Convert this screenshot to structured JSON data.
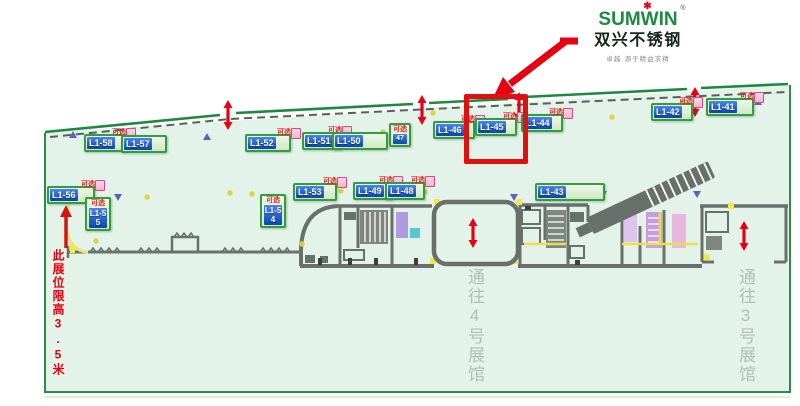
{
  "brand": {
    "logo_text": "SUMWIN",
    "logo_reg": "®",
    "logo_star": "✱",
    "name_cn": "双兴不锈钢",
    "tagline": "卓越·源于精益求精",
    "logo_green": "#1e8a41",
    "accent_red": "#e60012"
  },
  "map": {
    "optional_tag": "可选",
    "note_left": "此展位限高3.5米",
    "corridor_hall4": "通往4号展馆",
    "corridor_hall3": "通往3号展馆",
    "highlighted_booth": "L1-45",
    "colors": {
      "floor_fill": "#e4f3e9",
      "boundary_green": "#1c8a3e",
      "wall_gray": "#68706b",
      "booth_blue": "#0a48b0",
      "chip_border_green": "#2f9e3f",
      "highlight_red": "#e01010",
      "corridor_text_gray": "#b2bfb5"
    },
    "booths": [
      {
        "id": "L1-58"
      },
      {
        "id": "L1-57"
      },
      {
        "id": "L1-52"
      },
      {
        "id": "L1-51"
      },
      {
        "id": "L1-50"
      },
      {
        "id": "47"
      },
      {
        "id": "L1-46"
      },
      {
        "id": "L1-45"
      },
      {
        "id": "L1-44"
      },
      {
        "id": "L1-42"
      },
      {
        "id": "L1-41"
      },
      {
        "id": "L1-56"
      },
      {
        "id": "L1-55"
      },
      {
        "id": "L1-54"
      },
      {
        "id": "L1-53"
      },
      {
        "id": "L1-49"
      },
      {
        "id": "L1-48"
      },
      {
        "id": "L1-43"
      }
    ]
  }
}
